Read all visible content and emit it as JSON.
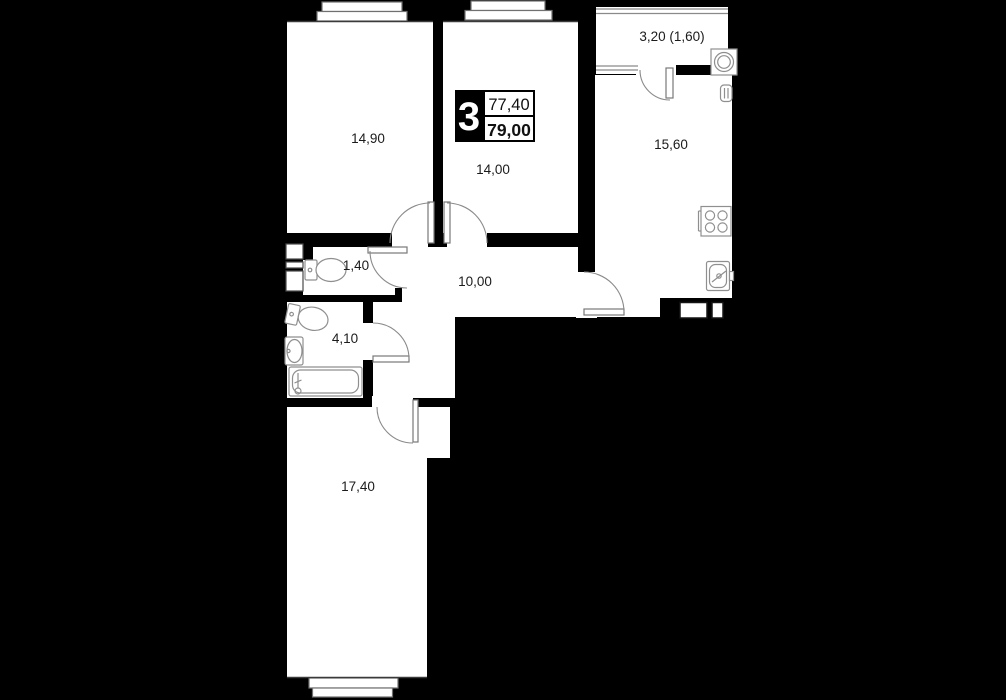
{
  "floorplan": {
    "badge": {
      "room_count": "3",
      "area_top": "77,40",
      "area_bottom": "79,00"
    },
    "rooms": {
      "bedroom": {
        "label": "14,90"
      },
      "room2": {
        "label": "14,00"
      },
      "balcony": {
        "label": "3,20 (1,60)"
      },
      "kitchen": {
        "label": "15,60"
      },
      "wc": {
        "label": "1,40"
      },
      "hallway": {
        "label": "10,00"
      },
      "bathroom": {
        "label": "4,10"
      },
      "living": {
        "label": "17,40"
      }
    },
    "fixtures": [
      "toilet",
      "toilet",
      "wash-basin",
      "bathtub",
      "stove",
      "kitchen-sink",
      "washing-machine",
      "water-heater",
      "ventilation-shaft"
    ],
    "colors": {
      "background": "#000000",
      "walls": "#000000",
      "room_fill": "#ffffff",
      "fixture_stroke": "#8f8f8f",
      "label_color": "#1b1b1b",
      "badge_bg": "#000000",
      "badge_text": "#ffffff"
    }
  }
}
